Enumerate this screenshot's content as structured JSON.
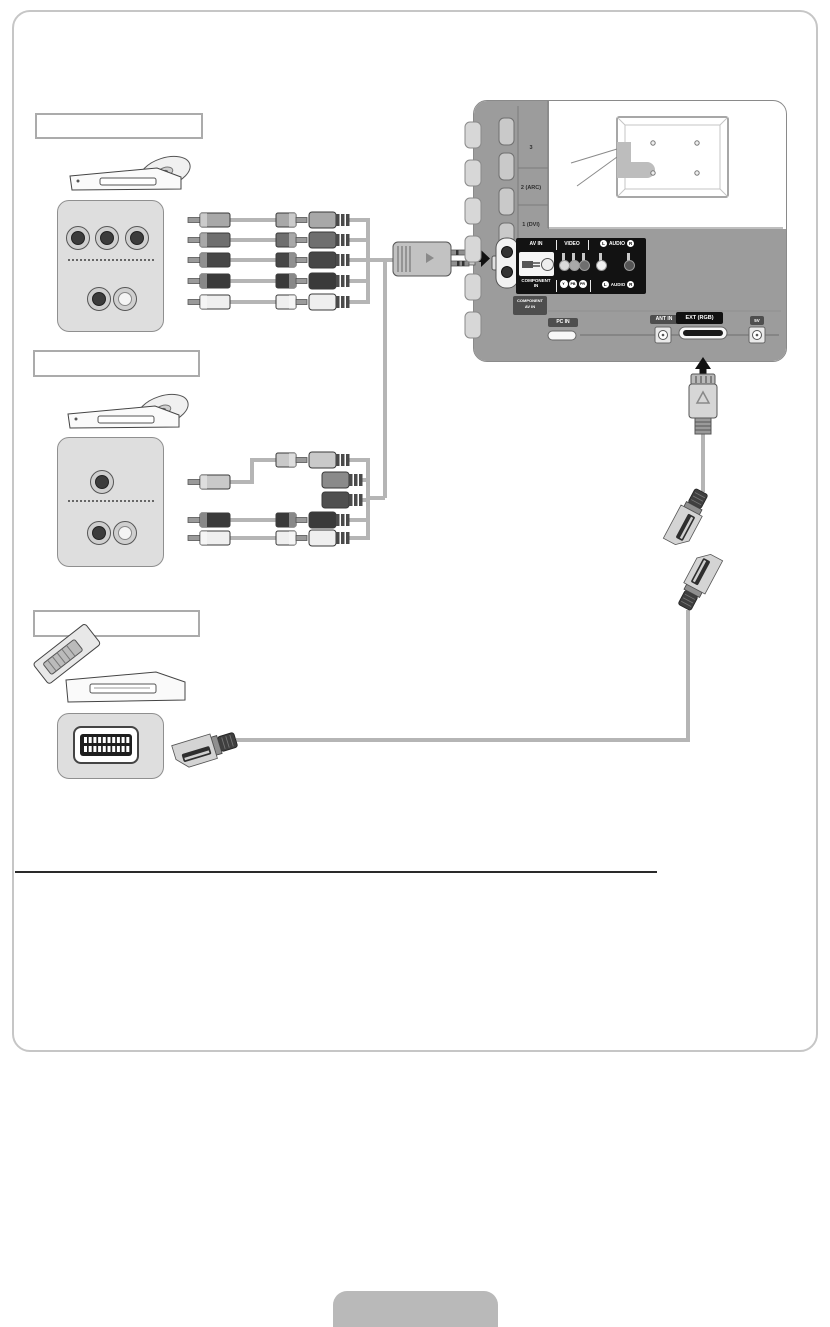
{
  "sections": [
    {
      "label": ""
    },
    {
      "label": ""
    },
    {
      "label": ""
    }
  ],
  "tv": {
    "hdmi_labels": [
      "3",
      "2 (ARC)",
      "1 (DVI)"
    ],
    "panel": {
      "av_in": "AV IN",
      "video": "VIDEO",
      "audio": "AUDIO",
      "l": "L",
      "r": "R",
      "component_line1": "COMPONENT",
      "component_line2": "IN",
      "y": "Y",
      "pb": "PB",
      "pr": "PR"
    },
    "side_badge": {
      "line1": "COMPONENT",
      "line2": "AV IN"
    },
    "bottom_ports": {
      "pc_in": "PC IN",
      "ant_in": "ANT IN",
      "ext_rgb": "EXT (RGB)",
      "aux": "5V"
    }
  },
  "icons": {
    "devices": [
      "dvd-player",
      "disc",
      "dvd-player-2",
      "vcr",
      "cassette"
    ],
    "connectors": [
      "rca-plug",
      "rca-coupler",
      "rca-socket",
      "component-av-adapter",
      "scart-plug",
      "scart-adapter-female",
      "scart-adapter-male",
      "scart-socket",
      "proprietary-connector"
    ],
    "arrows": [
      "arrow-right",
      "arrow-up"
    ],
    "tv": [
      "tv-rear",
      "mount-screws",
      "corner-callout"
    ]
  },
  "colors": {
    "page_bg": "#ffffff",
    "sheet_border": "#c6c6c6",
    "tv_gray": "#9c9c9c",
    "panel_black": "#121212",
    "cable_gray": "#b5b5b5",
    "badge_dark": "#4e4e4e",
    "badge_black": "#111111",
    "device_panel": "#dedede",
    "plug_light": "#efefef",
    "plug_dark": "#3a3a3a"
  }
}
